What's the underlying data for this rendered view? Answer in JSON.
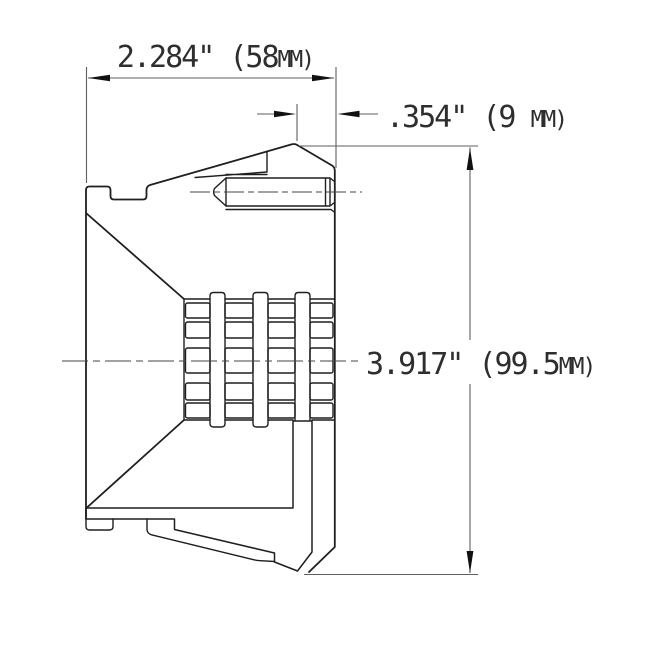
{
  "diagram": {
    "dimensions": {
      "width": {
        "label": "2.284\" (58MM)",
        "value": "2.284\" (58",
        "unit": "MM)"
      },
      "offset": {
        "label": ".354\" (9 MM)",
        "value": ".354\" (9 ",
        "unit": "MM)"
      },
      "diameter": {
        "label": "3.917\" (99.5MM)",
        "value": "3.917\" (99.5",
        "unit": "MM)"
      }
    },
    "colors": {
      "background": "#ffffff",
      "part_line": "#1f1f1f",
      "dim_line": "#5f5f5f",
      "centerline": "#444444",
      "hatch": "#222222",
      "text": "#2e2e2e",
      "arrow_fill": "#111111"
    }
  }
}
